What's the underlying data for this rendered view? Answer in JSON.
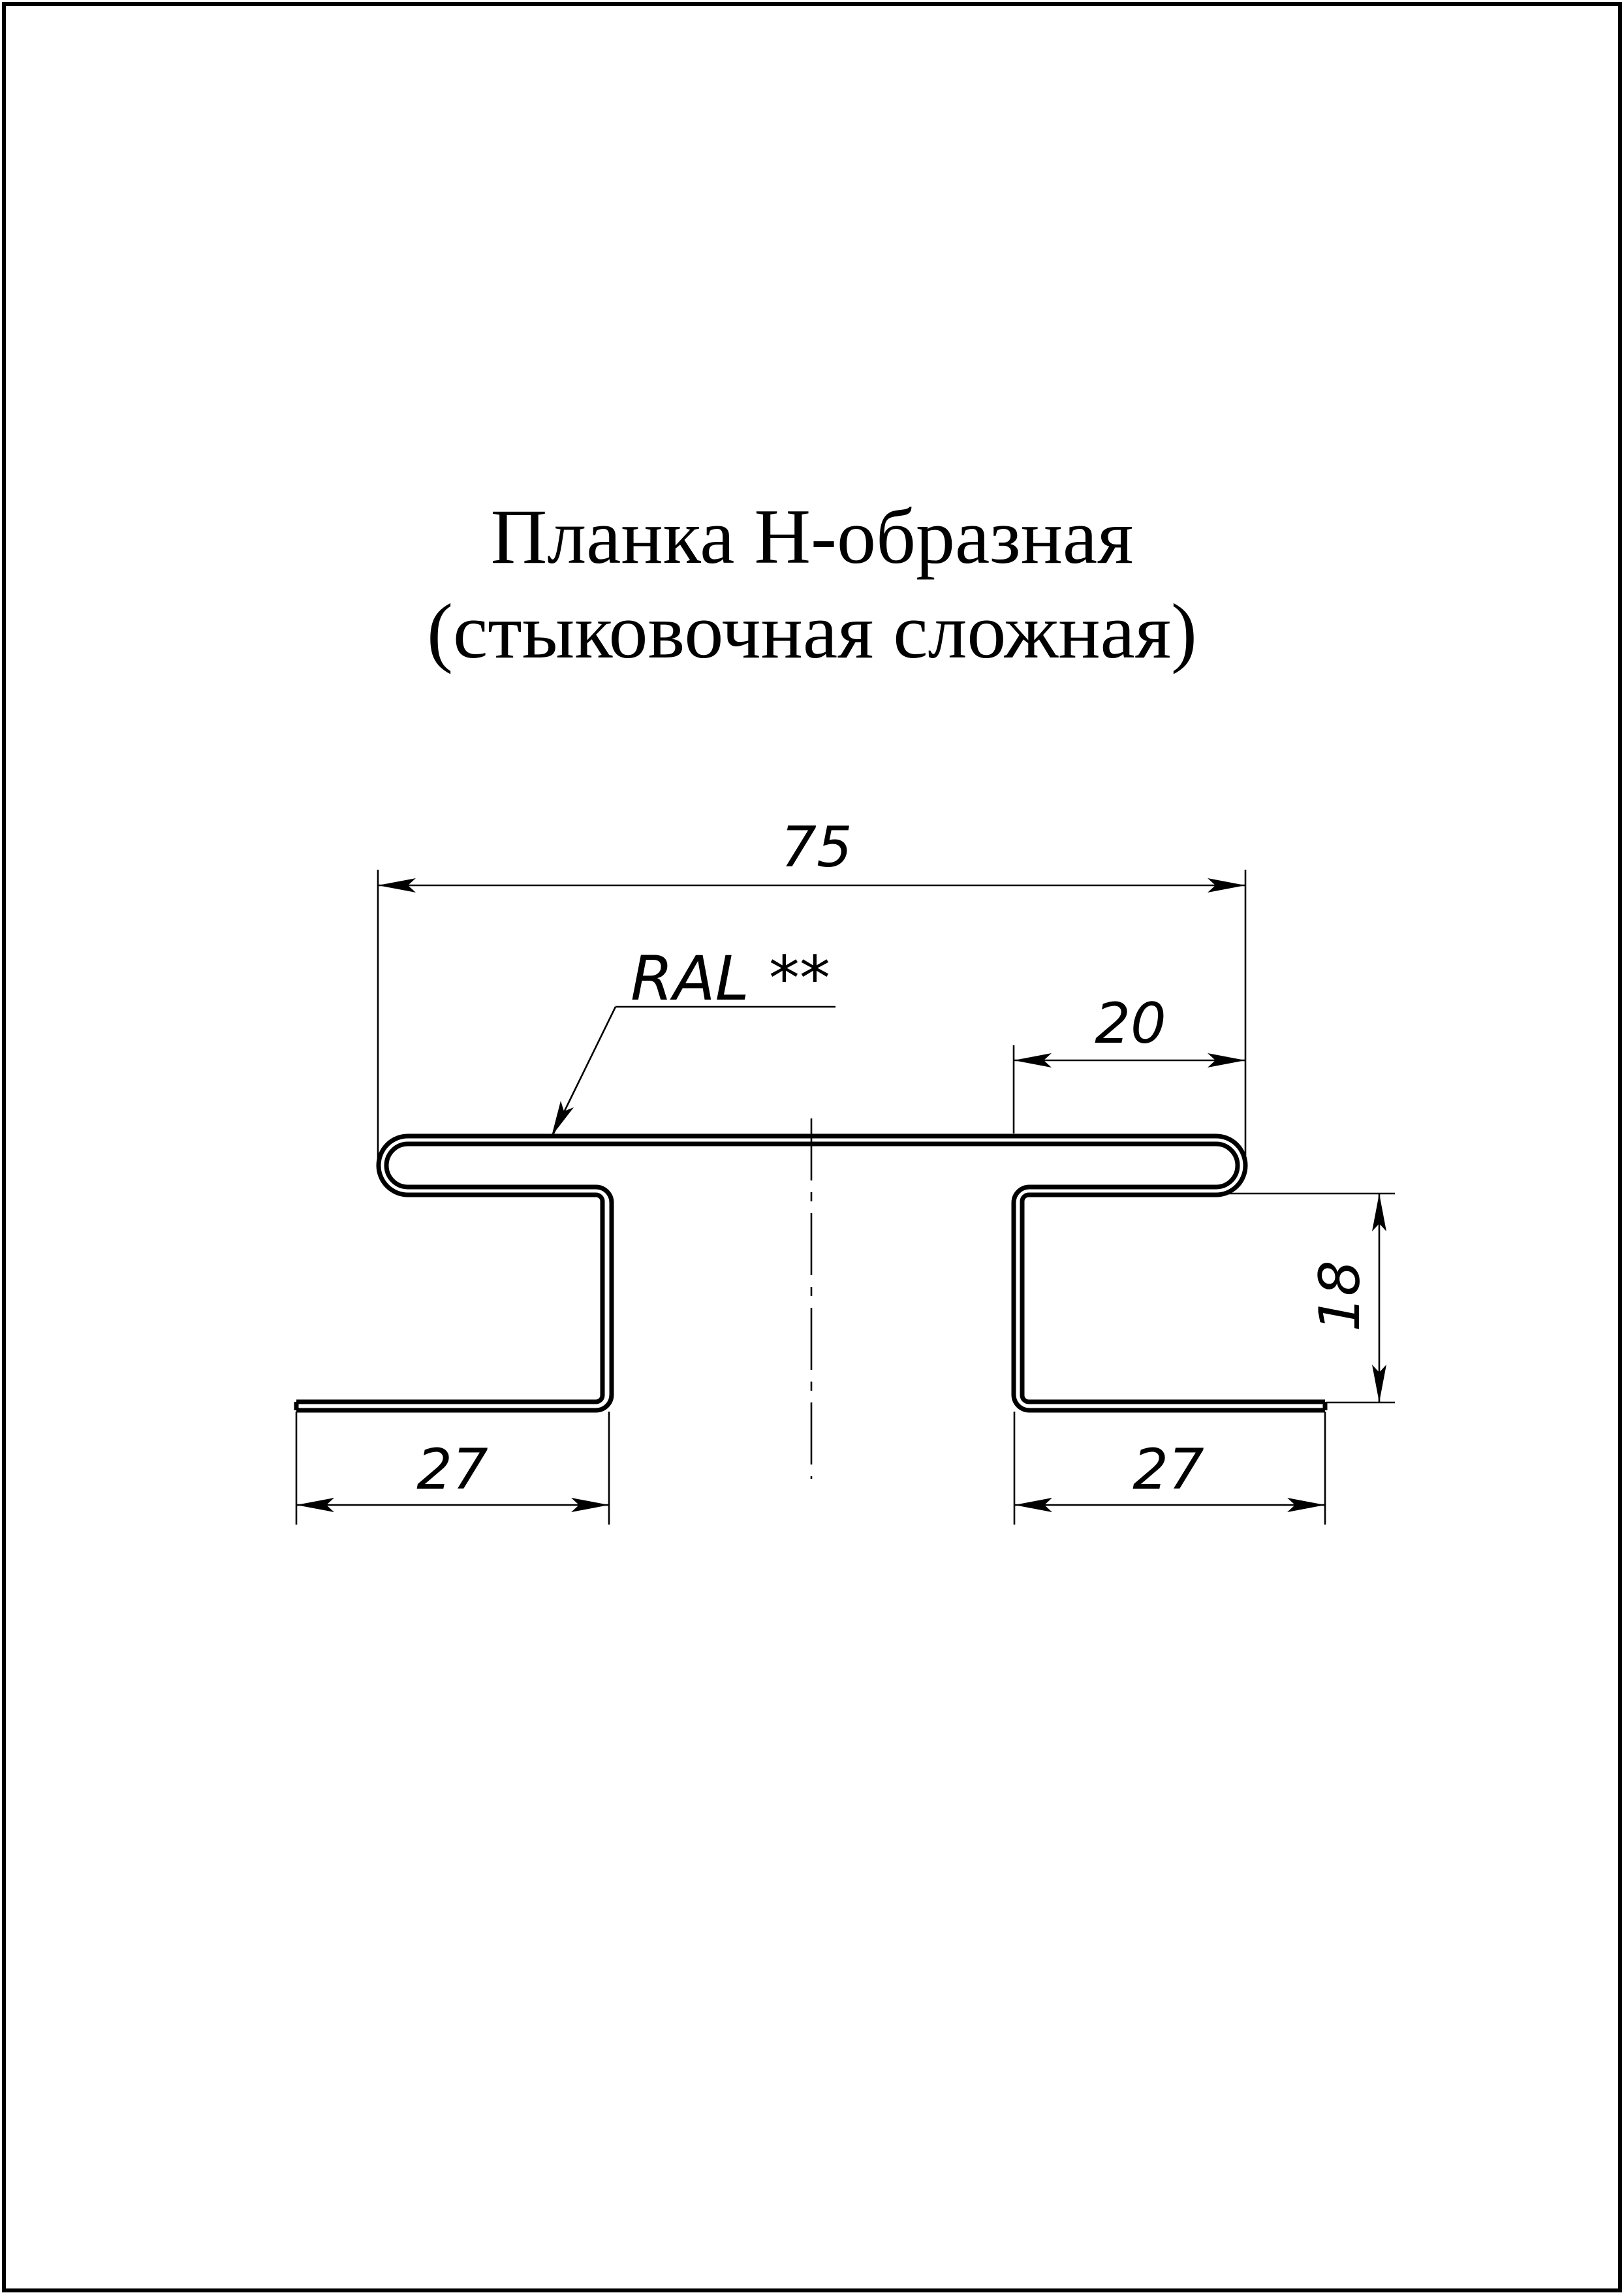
{
  "title": {
    "line1": "Планка Н-образная",
    "line2": "(стыковочная сложная)"
  },
  "callout": {
    "ral": "RAL **"
  },
  "dims": {
    "overall_width": "75",
    "right_top_offset": "20",
    "side_height": "18",
    "left_flange_width": "27",
    "right_flange_width": "27"
  },
  "colors": {
    "ink": "#000000",
    "paper": "#ffffff"
  }
}
